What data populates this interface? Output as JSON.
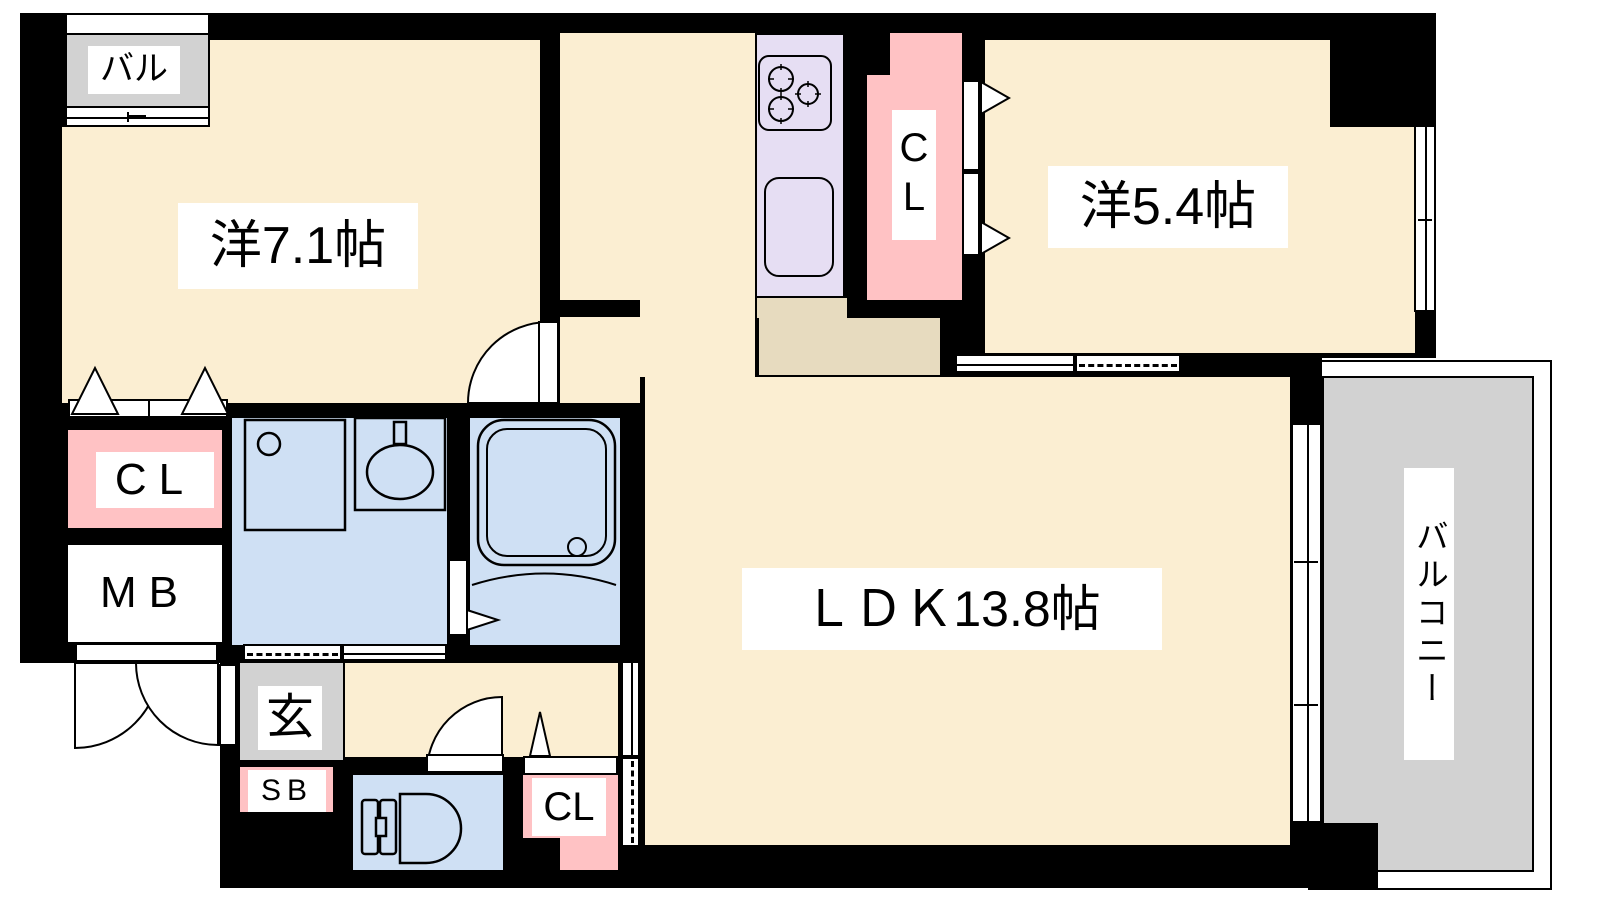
{
  "colors": {
    "wall": "#000000",
    "room": "#FBEED2",
    "water_room": "#CFE0F4",
    "closet": "#FFC2C4",
    "kitchen_unit": "#E6DEF3",
    "kitchen_counter": "#E7DBBF",
    "balcony": "#D2D2D2",
    "label_bg": "#FFFFFF"
  },
  "rooms": {
    "western_7_1": {
      "label": "洋7.1帖"
    },
    "western_5_4": {
      "label": "洋5.4帖"
    },
    "ldk": {
      "label": "ＬＤＫ13.8帖"
    },
    "balcony": {
      "label": "バルコニー"
    },
    "small_balcony": {
      "label": "バル"
    },
    "entrance": {
      "label": "玄"
    },
    "closet_bedroom_left": {
      "label": "CL"
    },
    "closet_bedroom_right": {
      "label": "CL"
    },
    "closet_hall": {
      "label": "CL"
    },
    "meter_box": {
      "label": "MB"
    },
    "shoe_box": {
      "label": "SB"
    }
  }
}
